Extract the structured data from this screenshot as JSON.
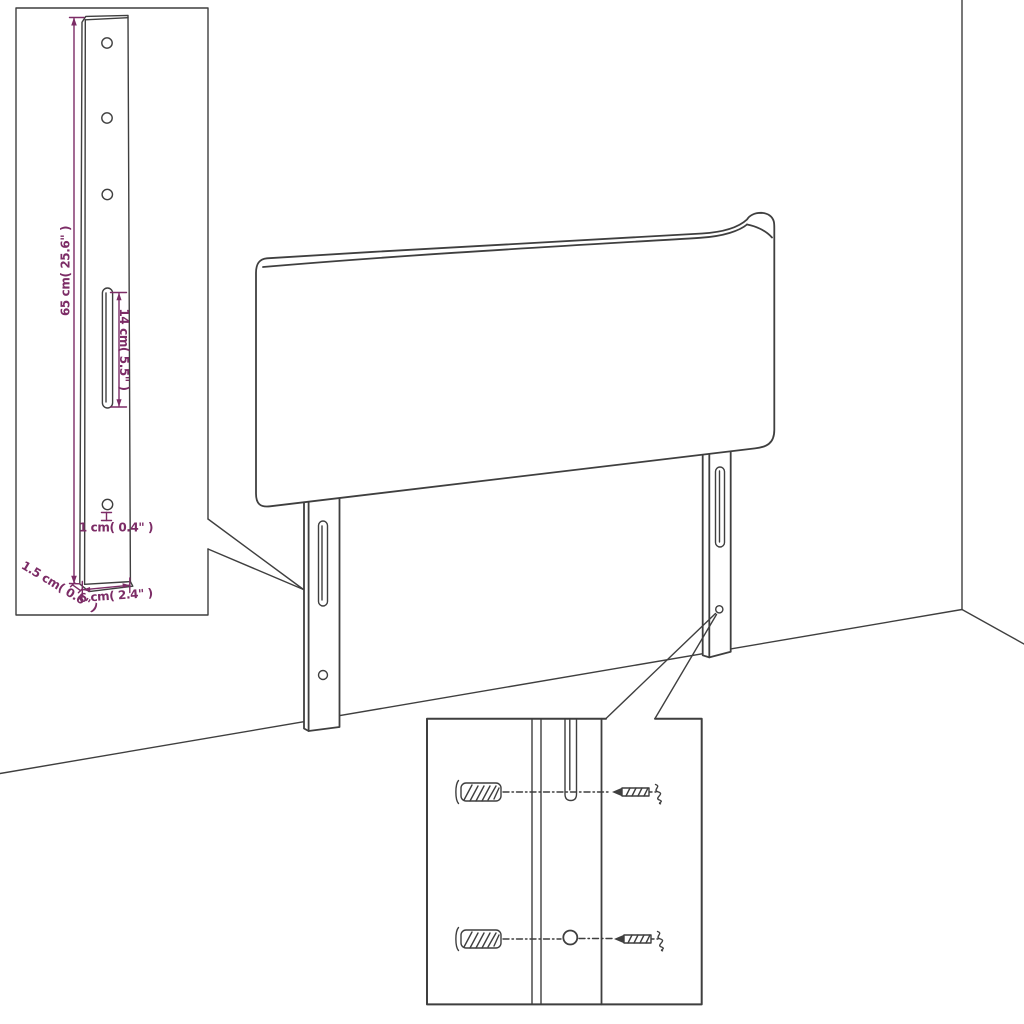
{
  "colors": {
    "background": "#ffffff",
    "line": "#3f3f3f",
    "dimension": "#7c2c66"
  },
  "leg_detail_inset": {
    "labels": {
      "height": "65 cm( 25.6\" )",
      "slot_length": "14 cm( 5.5\" )",
      "hole_size": "1 cm( 0.4\" )",
      "depth": "1.5 cm( 0.6\" )",
      "width": "6 cm( 2.4\" )"
    }
  },
  "mounting_detail_inset": {
    "parts": {
      "anchor": "wall-plug",
      "screw": "screw",
      "slot": "leg-slot",
      "hole": "leg-hole"
    }
  }
}
